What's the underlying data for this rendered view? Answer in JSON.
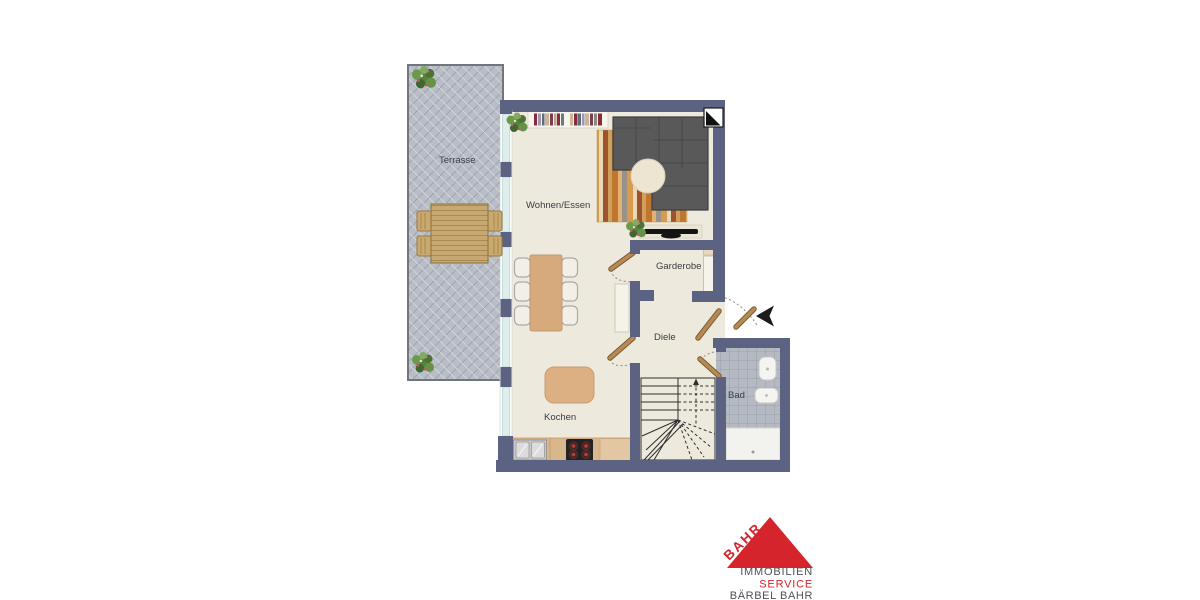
{
  "rooms": {
    "terrasse": {
      "label": "Terrasse"
    },
    "wohnen_essen": {
      "label": "Wohnen/Essen"
    },
    "garderobe": {
      "label": "Garderobe"
    },
    "diele": {
      "label": "Diele"
    },
    "kochen": {
      "label": "Kochen"
    },
    "bad": {
      "label": "Bad"
    }
  },
  "colors": {
    "wall": "#5b6282",
    "floor": "#edeadd",
    "terrace": "#b9bdc6",
    "tile": "#b4b9c2",
    "window_glass": "#ddeeec"
  },
  "logo": {
    "brand": "BAHR",
    "lines": {
      "l1": "IMMOBILIEN",
      "l2": "SERVICE",
      "l3": "BÄRBEL BAHR"
    },
    "red": "#d5242b",
    "gray": "#4f4f57"
  }
}
